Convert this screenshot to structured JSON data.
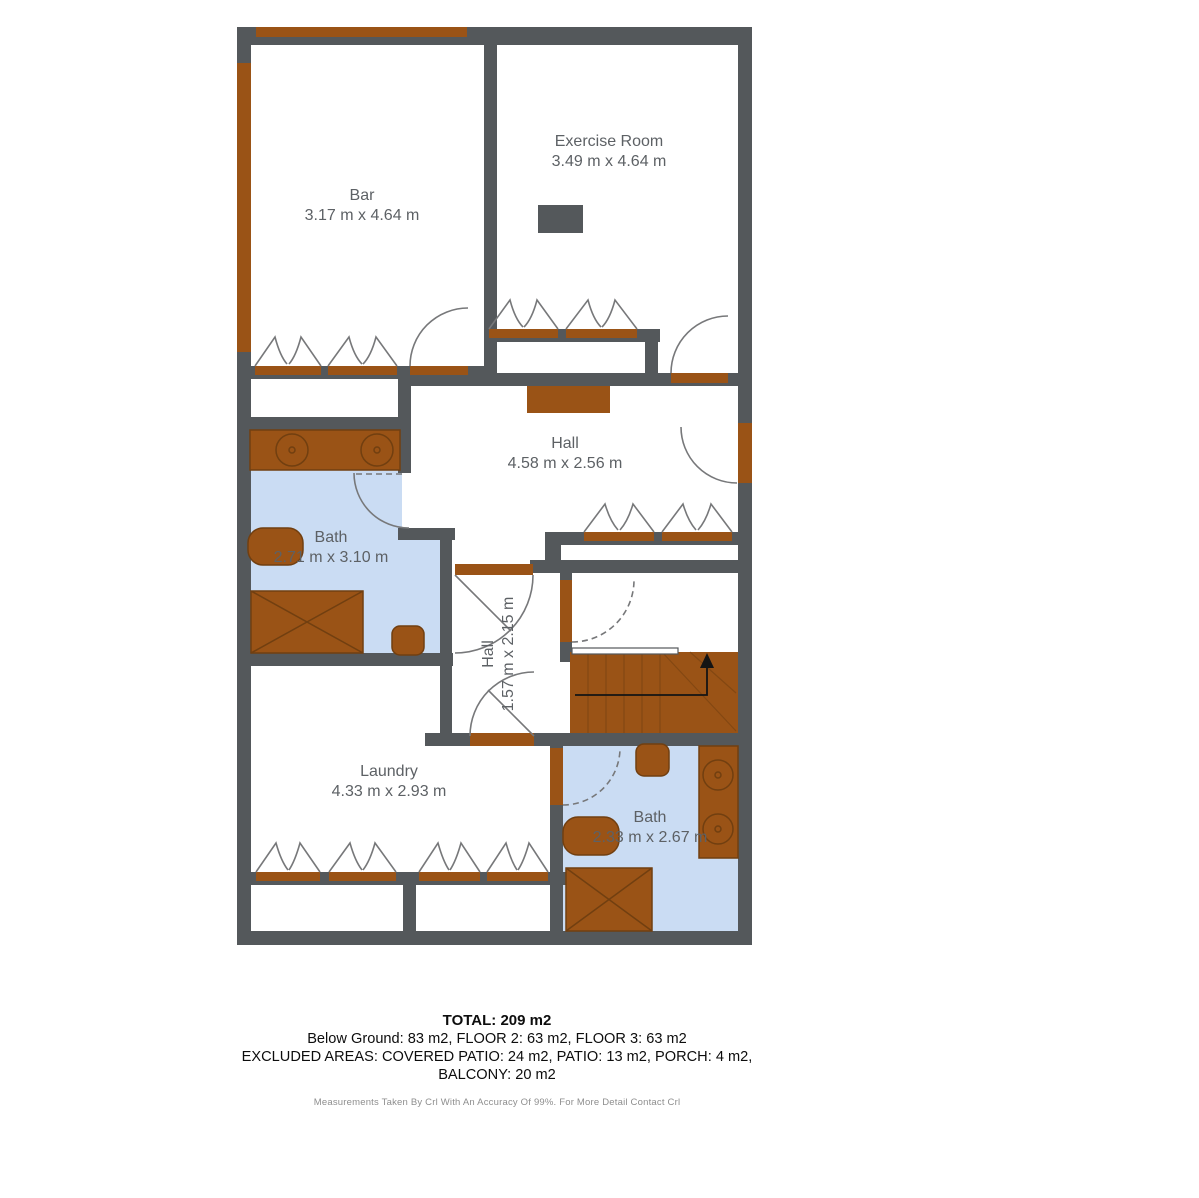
{
  "colors": {
    "wall": "#54585b",
    "wood": "#9a5316",
    "wood_dark": "#713f10",
    "water": "#cadcf3",
    "label": "#5d6165",
    "arc": "#77787a"
  },
  "rooms": {
    "bar": {
      "name": "Bar",
      "dims": "3.17 m x 4.64 m"
    },
    "exercise_room": {
      "name": "Exercise Room",
      "dims": "3.49 m x 4.64 m"
    },
    "hall_upper": {
      "name": "Hall",
      "dims": "4.58 m x 2.56 m"
    },
    "bath_upper": {
      "name": "Bath",
      "dims": "2.71 m x 3.10 m"
    },
    "hall_lower": {
      "name": "Hall",
      "dims": "1.57 m x 2.15 m"
    },
    "laundry": {
      "name": "Laundry",
      "dims": "4.33 m x 2.93 m"
    },
    "bath_lower": {
      "name": "Bath",
      "dims": "2.33 m x 2.67 m"
    }
  },
  "summary": {
    "total": "TOTAL: 209 m2",
    "floors": "Below Ground: 83 m2, FLOOR 2: 63 m2, FLOOR 3: 63 m2",
    "excluded_line1": "EXCLUDED AREAS: COVERED PATIO: 24 m2, PATIO: 13 m2, PORCH: 4 m2,",
    "excluded_line2": "BALCONY: 20 m2",
    "disclaimer": "Measurements Taken By Crl With An Accuracy Of 99%. For More Detail Contact Crl"
  }
}
